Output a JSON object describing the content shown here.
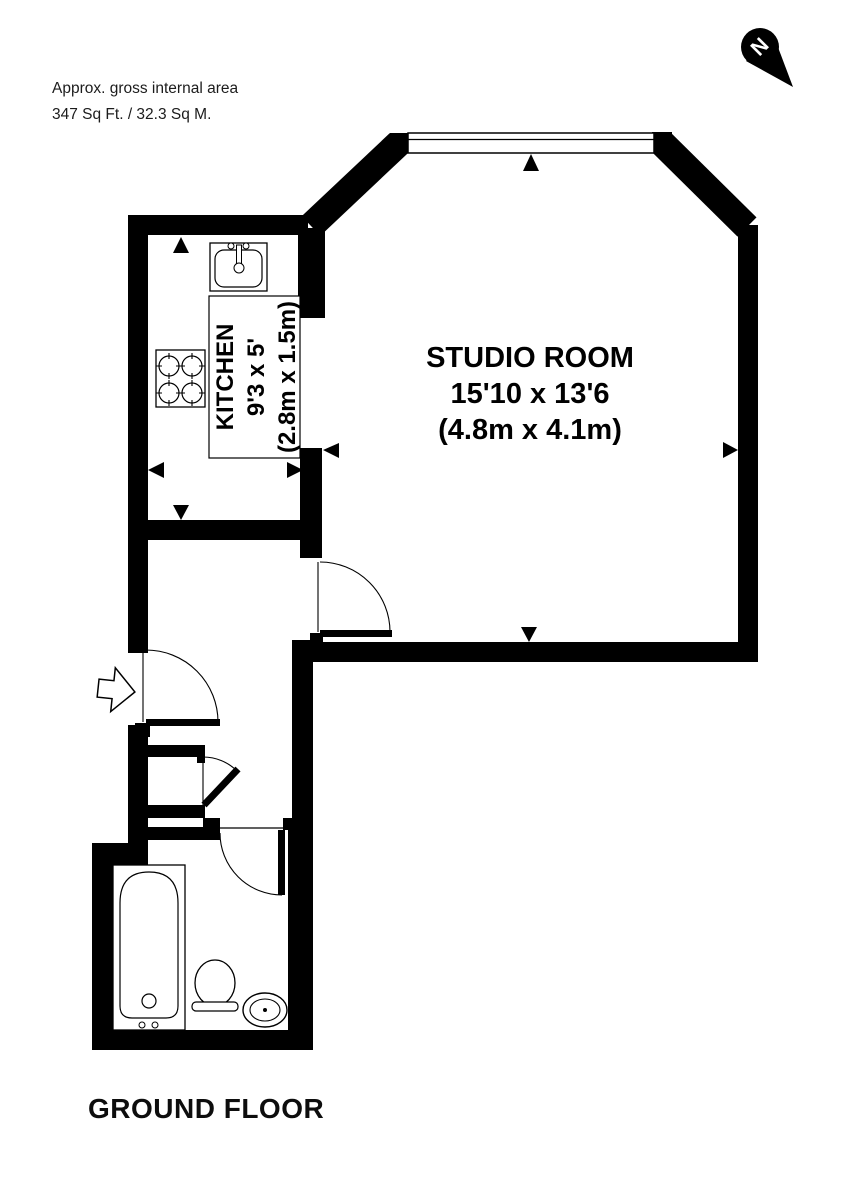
{
  "page": {
    "background": "#ffffff",
    "ink": "#000000",
    "note_color": "#1c1c1c"
  },
  "header": {
    "area_note_line1": "Approx. gross internal area",
    "area_note_line2": "347 Sq Ft. / 32.3 Sq M."
  },
  "compass": {
    "label": "N"
  },
  "rooms": {
    "studio": {
      "name": "STUDIO ROOM",
      "size_imperial": "15'10 x 13'6",
      "size_metric": "(4.8m x 4.1m)"
    },
    "kitchen": {
      "name": "KITCHEN",
      "size_imperial": "9'3 x 5'",
      "size_metric": "(2.8m x 1.5m)"
    }
  },
  "footer": {
    "floor_label": "GROUND FLOOR"
  },
  "symbols": {
    "north_icon": "north-compass-needle",
    "entry_icon": "entrance-arrow",
    "fixtures": [
      "kitchen-sink",
      "cooker-hob",
      "bathtub",
      "toilet",
      "wash-basin"
    ],
    "door_swings": 4,
    "window_count": 1
  }
}
